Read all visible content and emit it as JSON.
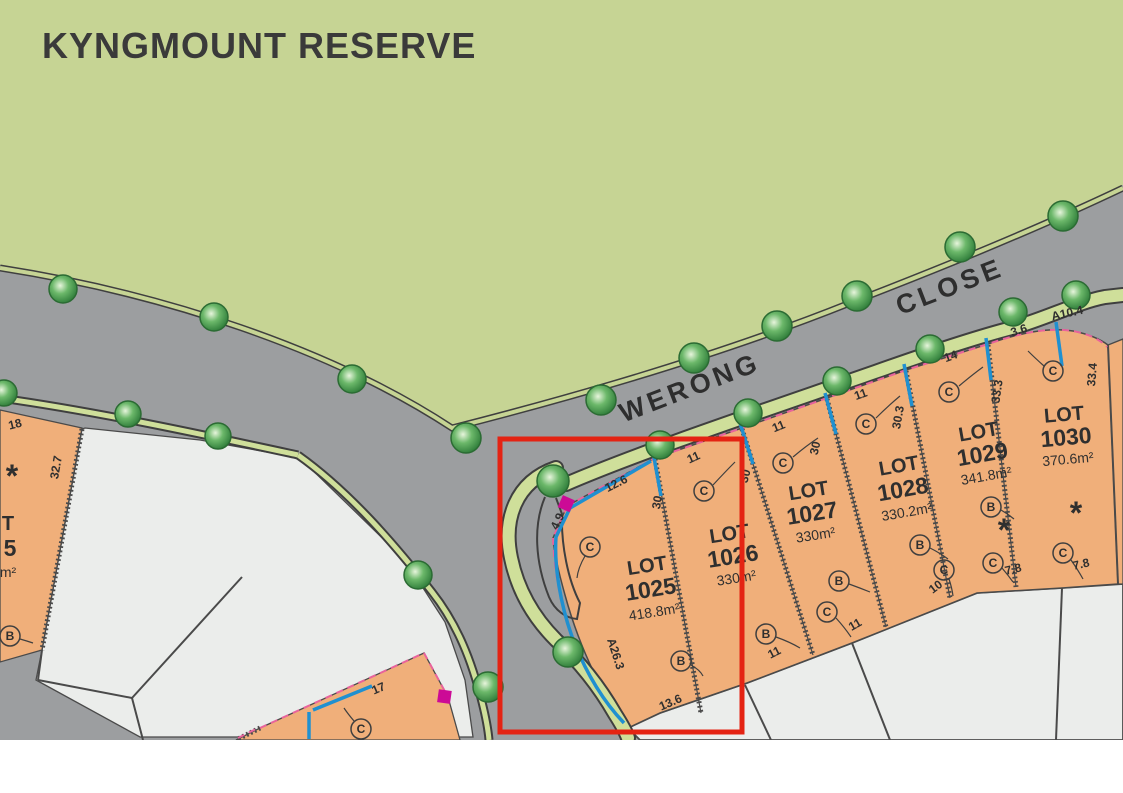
{
  "title": "KYNGMOUNT RESERVE",
  "street": {
    "word1": "WERONG",
    "word2": "CLOSE"
  },
  "lots": {
    "l1025": {
      "lot_word": "LOT",
      "number": "1025",
      "area": "418.8m²"
    },
    "l1026": {
      "lot_word": "LOT",
      "number": "1026",
      "area": "330m²"
    },
    "l1027": {
      "lot_word": "LOT",
      "number": "1027",
      "area": "330m²"
    },
    "l1028": {
      "lot_word": "LOT",
      "number": "1028",
      "area": "330.2m²"
    },
    "l1029": {
      "lot_word": "LOT",
      "number": "1029",
      "area": "341.8m²"
    },
    "l1030": {
      "lot_word": "LOT",
      "number": "1030",
      "area": "370.6m²"
    }
  },
  "dimensions": {
    "front_1025": "12.6",
    "splay_1025": "4.9",
    "arc_1025": "A26.3",
    "rear_1025": "13.6",
    "front_1026": "11",
    "rear_1026": "11",
    "front_1027": "11",
    "rear_1027": "11",
    "front_1028": "11",
    "rear_1028": "10",
    "front_1029": "14",
    "rear_1029": "7.8",
    "front_1030": "3.6",
    "arc_1030": "A10.4",
    "side_1030": "33.4",
    "rear_1030": "7.8",
    "depth_1025_1026": "30",
    "depth_1026_1027": "30",
    "depth_1027_1028": "30",
    "depth_1028_1029": "30.3",
    "depth_1029_1030": "33.3",
    "left_lot_front": "18",
    "left_lot_side": "32.7",
    "bottom_lot_front": "17"
  },
  "markers": {
    "type_b": "B",
    "type_c": "C",
    "star": "*"
  },
  "partial_left_lot": {
    "lot_word_fragment": "T",
    "number_fragment": "5",
    "area_fragment": "m²"
  },
  "colors": {
    "reserve": "#c6d494",
    "road": "#9c9ea0",
    "lot": "#f0af7a",
    "open_lot": "#ebedeb",
    "verge": "#cfdf9a",
    "highlight": "#e42313",
    "annotation_pink": "#e8639c",
    "annotation_blue": "#2090d0",
    "annotation_magenta": "#cc0a96"
  }
}
